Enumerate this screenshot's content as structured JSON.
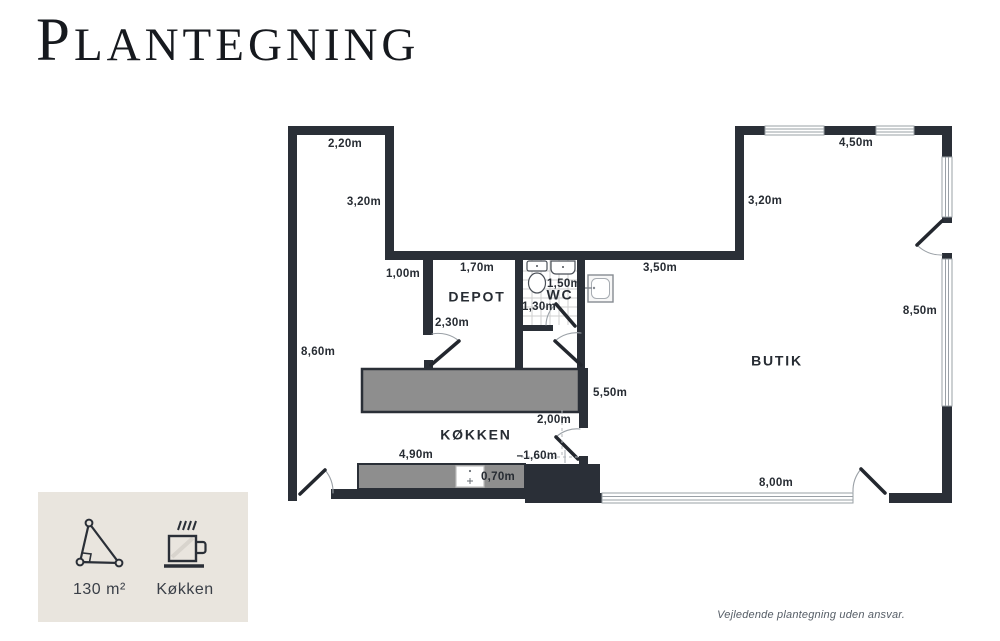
{
  "page": {
    "title_initial": "P",
    "title_rest": "LANTEGNING",
    "disclaimer": "Vejledende plantegning uden ansvar."
  },
  "legend": {
    "area_value": "130 m²",
    "kitchen_label": "Køkken"
  },
  "colors": {
    "wall": "#2a2f37",
    "counter": "#8e8e8e",
    "legend_background": "#e9e5de",
    "label_text": "#272c33",
    "disclaimer_text": "#555d66",
    "window_line": "#9aa0a6",
    "door_arc": "#9aa0a6",
    "tile_line": "#cfcfcf"
  },
  "floorplan": {
    "rooms": [
      {
        "name": "DEPOT"
      },
      {
        "name": "WC"
      },
      {
        "name": "KØKKEN"
      },
      {
        "name": "BUTIK"
      }
    ],
    "dimensions": [
      {
        "text": "2,20m"
      },
      {
        "text": "3,20m"
      },
      {
        "text": "1,00m"
      },
      {
        "text": "1,70m"
      },
      {
        "text": "2,30m"
      },
      {
        "text": "1,50m"
      },
      {
        "text": "1,30m"
      },
      {
        "text": "3,50m"
      },
      {
        "text": "3,20m"
      },
      {
        "text": "4,50m"
      },
      {
        "text": "8,60m"
      },
      {
        "text": "8,50m"
      },
      {
        "text": "5,50m"
      },
      {
        "text": "2,00m"
      },
      {
        "text": "4,90m"
      },
      {
        "text": "–1,60m"
      },
      {
        "text": "0,70m"
      },
      {
        "text": "8,00m"
      }
    ]
  }
}
